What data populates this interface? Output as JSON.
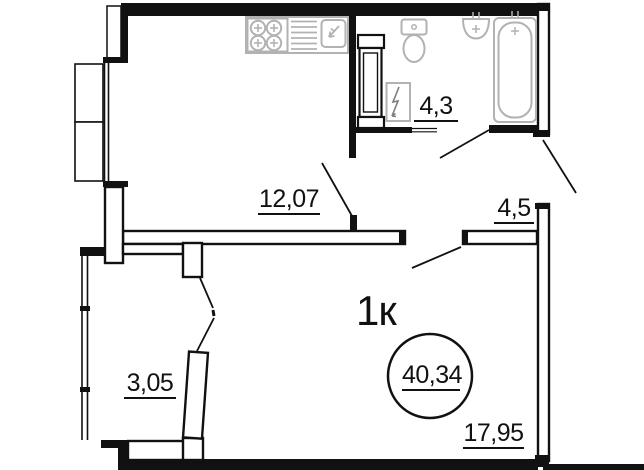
{
  "plan": {
    "apartment_type": "1к",
    "total_area": "40,34",
    "rooms": [
      {
        "id": "kitchen-living",
        "area": "12,07"
      },
      {
        "id": "bathroom",
        "area": "4,3"
      },
      {
        "id": "hallway",
        "area": "4,5"
      },
      {
        "id": "loggia",
        "area": "3,05"
      },
      {
        "id": "living-room",
        "area": "17,95"
      }
    ],
    "colors": {
      "walls": "#111111",
      "fixtures": "#b2b2b2",
      "background": "#ffffff"
    },
    "icons": [
      "stove-icon",
      "dish-drainer-icon",
      "sink-icon",
      "toilet-icon",
      "washbasin-icon",
      "bathtub-icon",
      "water-heater-icon"
    ]
  }
}
